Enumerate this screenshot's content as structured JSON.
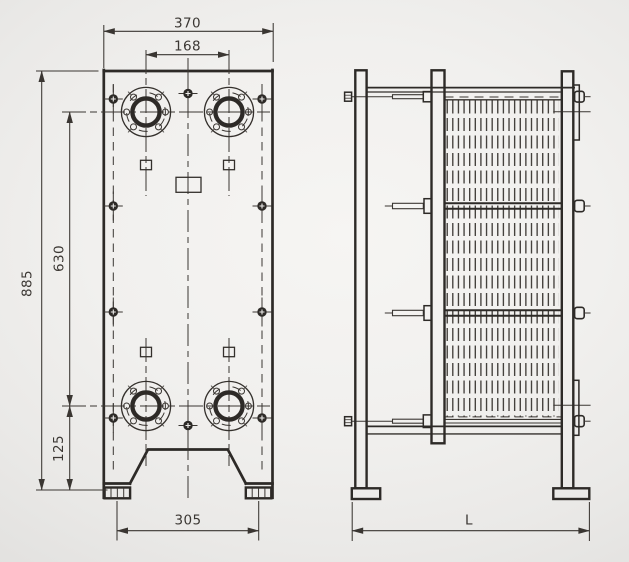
{
  "drawing": {
    "subject": "plate-heat-exchanger-dimension-drawing",
    "front": {
      "overall_width": "370",
      "port_spacing_horizontal": "168",
      "overall_height": "885",
      "port_spacing_vertical": "630",
      "foot_zone_height": "125",
      "foot_span": "305"
    },
    "side": {
      "frame_length": "L"
    },
    "colors": {
      "line_bold": "#2d2a27",
      "line_thin": "#3a3632",
      "background": "#efeeec"
    }
  }
}
